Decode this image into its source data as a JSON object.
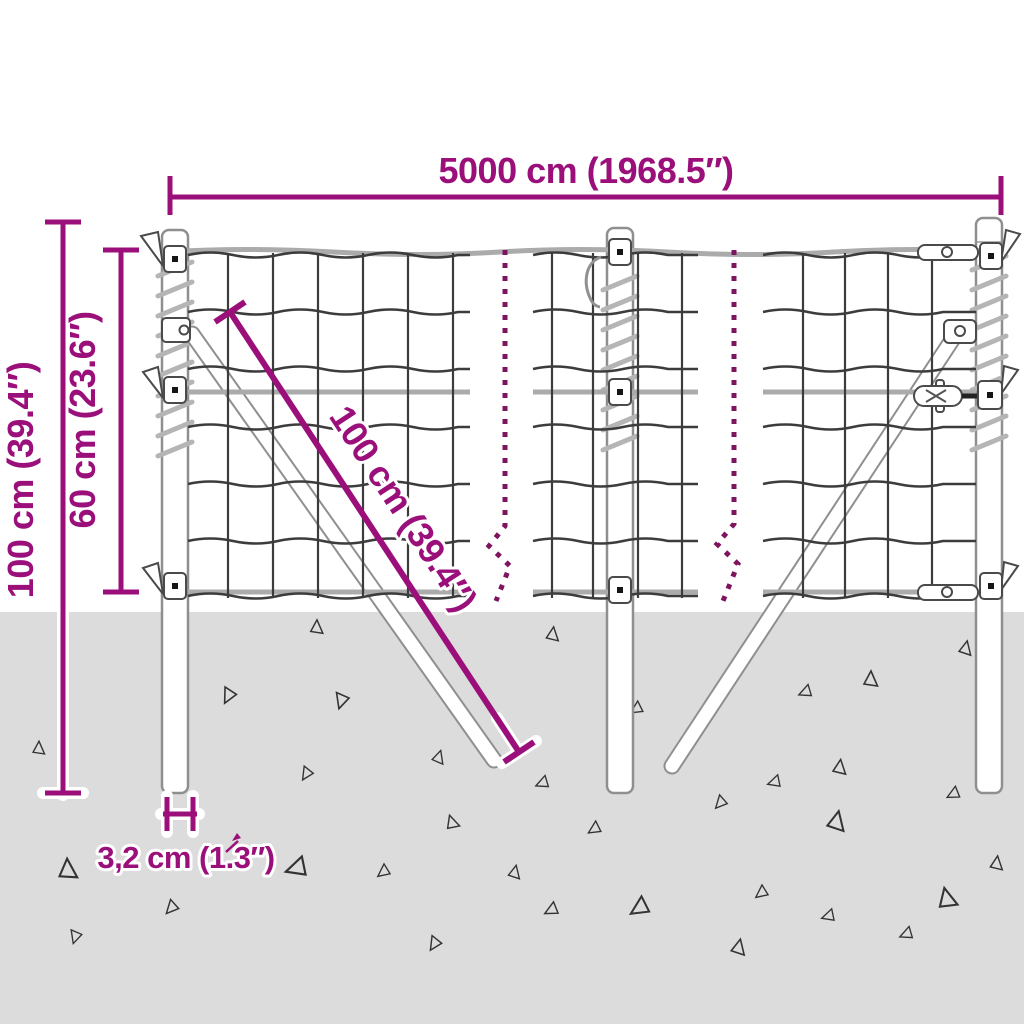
{
  "labels": {
    "total_width": "5000 cm (1968.5″)",
    "post_height": "100 cm (39.4″)",
    "mesh_height": "60 cm (23.6″)",
    "brace_length": "100 cm (39.4″)",
    "post_diameter": "3,2 cm (1.3″)"
  },
  "colors": {
    "dimension": "#9B0F7B",
    "break_line": "#7E145E",
    "ground": "#DCDCDC",
    "mesh_wire": "#3C3C3C",
    "metal_outline": "#8F8F8F",
    "background": "#FFFFFF"
  }
}
